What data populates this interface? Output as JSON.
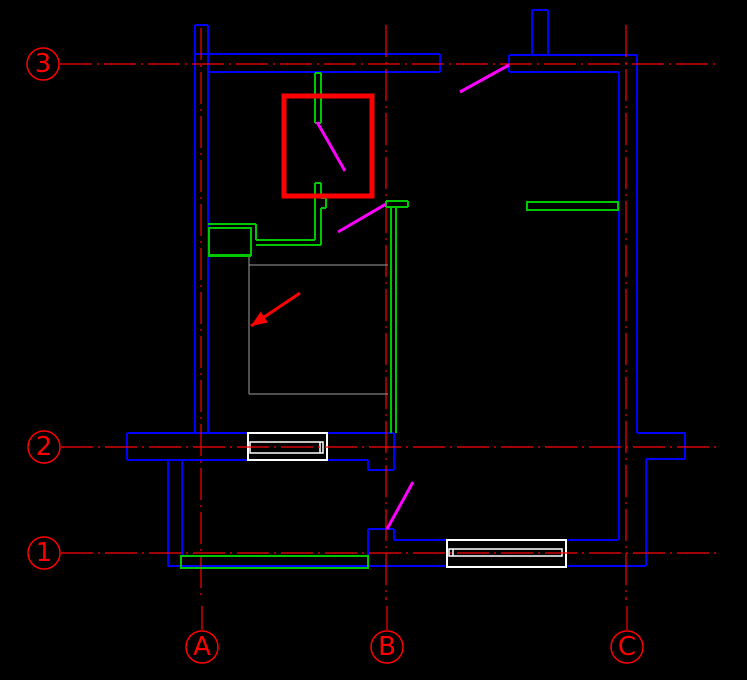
{
  "canvas": {
    "width": 747,
    "height": 680,
    "background": "#000000"
  },
  "colors": {
    "axis": "#ff0000",
    "wall": "#0000ff",
    "fixture": "#00c800",
    "door": "#ff00ff",
    "window": "#ffffff",
    "outline": "#9e9e9e",
    "highlight": "#ff0000",
    "arrow": "#ff0000"
  },
  "axes": {
    "dash_pattern": "32 5 2 5",
    "horizontal": [
      {
        "label": "3",
        "cx": 43,
        "cy": 64,
        "r": 16,
        "x1": 60,
        "y1": 64,
        "x2": 717,
        "y2": 64
      },
      {
        "label": "2",
        "cx": 44,
        "cy": 447,
        "r": 16,
        "x1": 61,
        "y1": 447,
        "x2": 717,
        "y2": 447
      },
      {
        "label": "1",
        "cx": 44,
        "cy": 553,
        "r": 16,
        "x1": 61,
        "y1": 553,
        "x2": 717,
        "y2": 553
      }
    ],
    "vertical": [
      {
        "label": "A",
        "cx": 202,
        "cy": 647,
        "r": 16,
        "x1": 201,
        "y1": 28,
        "x2": 201,
        "y2": 600,
        "tick": [
          202,
          606,
          202,
          630
        ]
      },
      {
        "label": "B",
        "cx": 387,
        "cy": 647,
        "r": 16,
        "x1": 386,
        "y1": 25,
        "x2": 386,
        "y2": 600,
        "tick": [
          387,
          606,
          387,
          630
        ]
      },
      {
        "label": "C",
        "cx": 627,
        "cy": 647,
        "r": 16,
        "x1": 626,
        "y1": 25,
        "x2": 626,
        "y2": 600,
        "tick": [
          627,
          606,
          627,
          630
        ]
      }
    ]
  },
  "walls": {
    "lines": [
      [
        195,
        25,
        195,
        433
      ],
      [
        208,
        25,
        208,
        433
      ],
      [
        195,
        25,
        208,
        25
      ],
      [
        195,
        54,
        440,
        54
      ],
      [
        208,
        72,
        440,
        72
      ],
      [
        440,
        54,
        440,
        72
      ],
      [
        509,
        55,
        637,
        55
      ],
      [
        509,
        72,
        619,
        72
      ],
      [
        509,
        55,
        509,
        72
      ],
      [
        532,
        10,
        532,
        55
      ],
      [
        548,
        10,
        548,
        55
      ],
      [
        532,
        10,
        548,
        10
      ],
      [
        637,
        55,
        637,
        433
      ],
      [
        619,
        72,
        619,
        540
      ],
      [
        637,
        433,
        685,
        433
      ],
      [
        685,
        433,
        685,
        459
      ],
      [
        646,
        459,
        685,
        459
      ],
      [
        646,
        459,
        646,
        566
      ],
      [
        127,
        433,
        394,
        433
      ],
      [
        127,
        433,
        127,
        460
      ],
      [
        127,
        460,
        368,
        460
      ],
      [
        368,
        460,
        368,
        470
      ],
      [
        368,
        470,
        394,
        470
      ],
      [
        394,
        433,
        394,
        470
      ],
      [
        168,
        460,
        168,
        566
      ],
      [
        182,
        460,
        182,
        556
      ],
      [
        168,
        566,
        646,
        566
      ],
      [
        368,
        529,
        394,
        529
      ],
      [
        368,
        529,
        368,
        556
      ],
      [
        394,
        529,
        394,
        540
      ],
      [
        394,
        540,
        618,
        540
      ]
    ]
  },
  "fixtures": {
    "lines": [
      [
        208,
        224,
        256,
        224
      ],
      [
        256,
        224,
        256,
        240
      ],
      [
        208,
        256,
        251,
        256
      ],
      [
        256,
        240,
        315,
        240
      ],
      [
        256,
        245,
        321,
        245
      ],
      [
        315,
        73,
        315,
        123
      ],
      [
        321,
        73,
        321,
        123
      ],
      [
        315,
        73,
        321,
        73
      ],
      [
        315,
        123,
        321,
        123
      ],
      [
        315,
        183,
        321,
        183
      ],
      [
        315,
        183,
        315,
        240
      ],
      [
        321,
        183,
        321,
        198
      ],
      [
        321,
        198,
        326,
        198
      ],
      [
        326,
        198,
        326,
        208
      ],
      [
        321,
        208,
        326,
        208
      ],
      [
        321,
        208,
        321,
        245
      ],
      [
        386,
        201,
        408,
        201
      ],
      [
        386,
        207,
        408,
        207
      ],
      [
        386,
        201,
        386,
        207
      ],
      [
        408,
        201,
        408,
        207
      ],
      [
        391,
        207,
        391,
        433
      ],
      [
        396,
        207,
        396,
        433
      ]
    ],
    "rects": [
      {
        "name": "sink-inner",
        "x": 209,
        "y": 228,
        "w": 42,
        "h": 27
      },
      {
        "name": "shelf",
        "x": 527,
        "y": 202,
        "w": 91,
        "h": 8
      },
      {
        "name": "balcony-sill",
        "x": 181,
        "y": 556,
        "w": 187,
        "h": 12
      }
    ]
  },
  "windows": [
    {
      "outer": [
        248,
        433,
        79,
        27
      ],
      "inner": [
        250,
        442,
        73,
        11
      ],
      "dividers": [
        [
          320,
          442,
          320,
          453
        ]
      ]
    },
    {
      "outer": [
        447,
        540,
        119,
        27
      ],
      "inner": [
        449,
        549,
        113,
        7
      ],
      "dividers": [
        [
          453,
          549,
          453,
          556
        ]
      ]
    }
  ],
  "doors": [
    [
      509,
      65,
      460,
      92
    ],
    [
      317,
      122,
      345,
      171
    ],
    [
      386,
      204,
      338,
      232
    ],
    [
      387,
      529,
      413,
      482
    ]
  ],
  "room_outline": [
    [
      249,
      257,
      249,
      394
    ],
    [
      249,
      394,
      388,
      394
    ],
    [
      249,
      265,
      388,
      265
    ]
  ],
  "highlight_rect": {
    "x": 284,
    "y": 96,
    "w": 88,
    "h": 100,
    "stroke_width": 5
  },
  "arrow": {
    "tail": [
      300,
      293
    ],
    "tip": [
      251,
      326
    ],
    "head_length": 16,
    "head_half_width": 6.5
  }
}
